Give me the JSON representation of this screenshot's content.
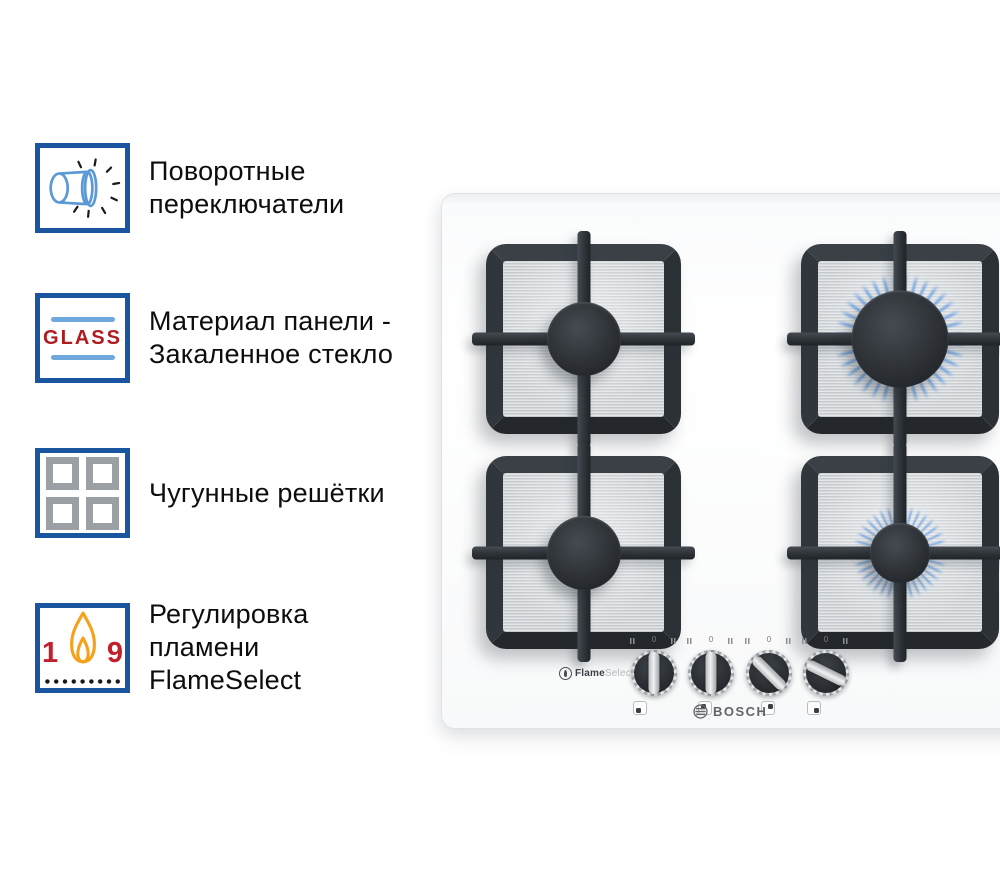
{
  "features": [
    {
      "icon": "rotary-switch-icon",
      "lines": [
        "Поворотные",
        "переключатели"
      ]
    },
    {
      "icon": "glass-panel-icon",
      "icon_text": "GLASS",
      "lines": [
        "Материал панели -",
        "Закаленное стекло"
      ]
    },
    {
      "icon": "cast-iron-grates-icon",
      "lines": [
        "Чугунные решётки"
      ]
    },
    {
      "icon": "flame-select-icon",
      "icon_min": "1",
      "icon_max": "9",
      "lines": [
        "Регулировка",
        "пламени",
        "FlameSelect"
      ]
    }
  ],
  "stove": {
    "brand_logo": "BOSCH",
    "flameselect_logo": {
      "bold": "Flame",
      "light": "Select"
    },
    "knob_zero_mark": "0",
    "knobs": [
      {
        "angle": 0
      },
      {
        "angle": 0
      },
      {
        "angle": -45
      },
      {
        "angle": -64
      }
    ],
    "burners": [
      {
        "position": "back-left",
        "flame": "off"
      },
      {
        "position": "back-right",
        "flame": "on-large"
      },
      {
        "position": "front-left",
        "flame": "off"
      },
      {
        "position": "front-right",
        "flame": "on-small"
      }
    ]
  },
  "colors": {
    "accent_border_blue": "#1a55a0",
    "icon_light_blue": "#5b9ad6",
    "glass_red": "#ae1c20",
    "number_red": "#c3202e",
    "flame_orange": "#f7a11a",
    "gas_flame_blue": "#6fa3e2",
    "grate_dark": "#2d3237",
    "steel_gray": "#d3d7da"
  }
}
